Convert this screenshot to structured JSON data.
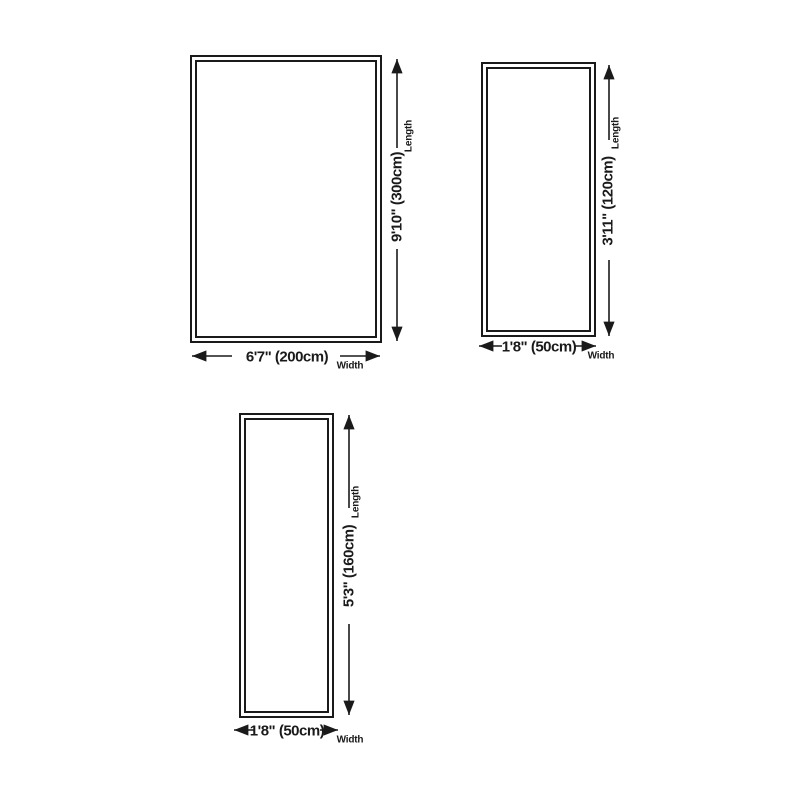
{
  "diagram": {
    "colors": {
      "background": "#ffffff",
      "line": "#1a1a1a",
      "text": "#1a1a1a"
    },
    "rugs": [
      {
        "name": "large-rug",
        "width_label": "6'7\" (200cm)",
        "length_label": "9'10\" (300cm)",
        "width_caption": "Width",
        "length_caption": "Length"
      },
      {
        "name": "small-runner-rug",
        "width_label": "1'8\" (50cm)",
        "length_label": "3'11\" (120cm)",
        "width_caption": "Width",
        "length_caption": "Length"
      },
      {
        "name": "long-runner-rug",
        "width_label": "1'8\" (50cm)",
        "length_label": "5'3\" (160cm)",
        "width_caption": "Width",
        "length_caption": "Length"
      }
    ]
  }
}
